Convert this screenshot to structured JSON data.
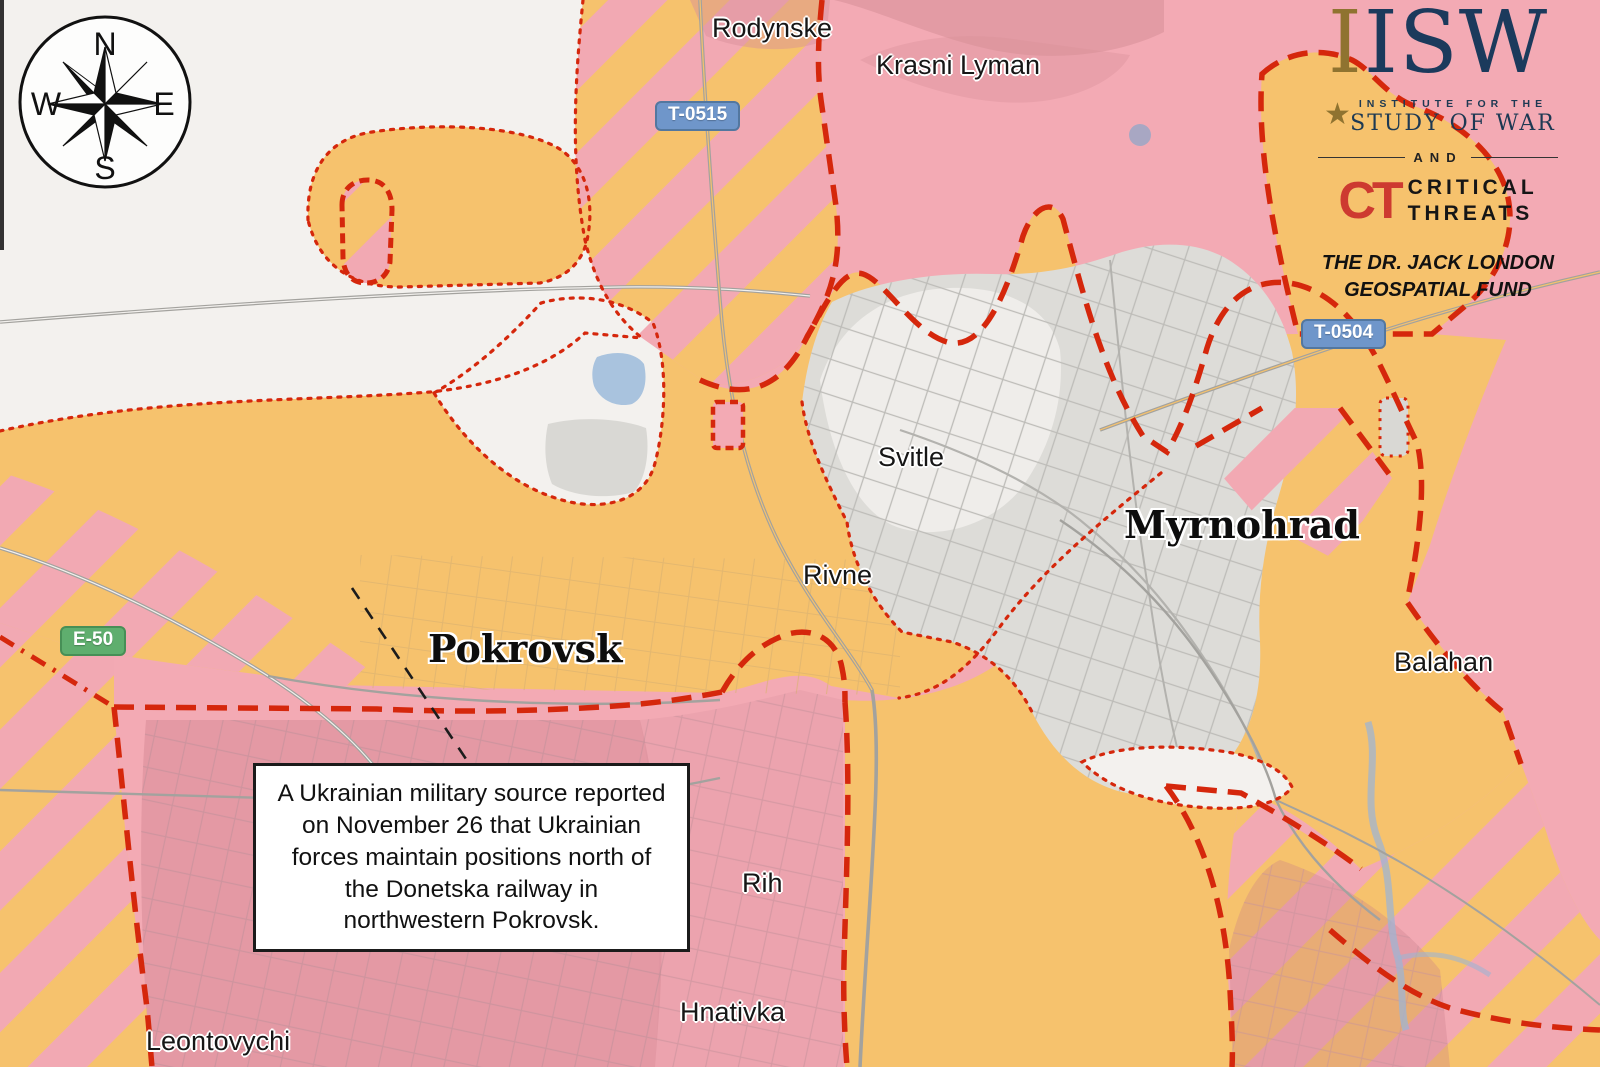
{
  "map": {
    "annotation": {
      "text": "A Ukrainian military source reported on November 26 that Ukrainian forces maintain positions north of the Donetska railway in northwestern Pokrovsk."
    },
    "compass": {
      "n": "N",
      "e": "E",
      "s": "S",
      "w": "W"
    },
    "towns": [
      {
        "name": "Rodynske"
      },
      {
        "name": "Krasni Lyman"
      },
      {
        "name": "Svitle"
      },
      {
        "name": "Rivne"
      },
      {
        "name": "Balahan"
      },
      {
        "name": "Rih"
      },
      {
        "name": "Hnativka"
      },
      {
        "name": "Leontovychi"
      }
    ],
    "cities": [
      {
        "name": "Pokrovsk"
      },
      {
        "name": "Myrnohrad"
      }
    ],
    "road_badges": [
      {
        "label": "T-0515"
      },
      {
        "label": "T-0504"
      },
      {
        "label": "E-50"
      }
    ],
    "colors": {
      "pink_area": "#f3aab4",
      "orange_area": "#f6c26d",
      "background": "#f3f1ee",
      "urban_gray": "#dddcd8",
      "front_line_red": "#d5270c",
      "badge_blue": "#6f96ca",
      "badge_green": "#5fae6e",
      "water_blue": "#a9c3de",
      "isw_navy": "#1b3a5c",
      "isw_gold": "#8f7330",
      "ct_red": "#cd3a30"
    }
  },
  "logo": {
    "isw": "ISW",
    "gold_i": "I",
    "star": "★",
    "institute_line": "INSTITUTE FOR THE",
    "study_line": "STUDY OF WAR",
    "and_label": "AND",
    "ct": "CT",
    "critical": "CRITICAL",
    "threats": "THREATS",
    "fund_line1": "THE DR. JACK LONDON",
    "fund_line2": "GEOSPATIAL FUND"
  }
}
